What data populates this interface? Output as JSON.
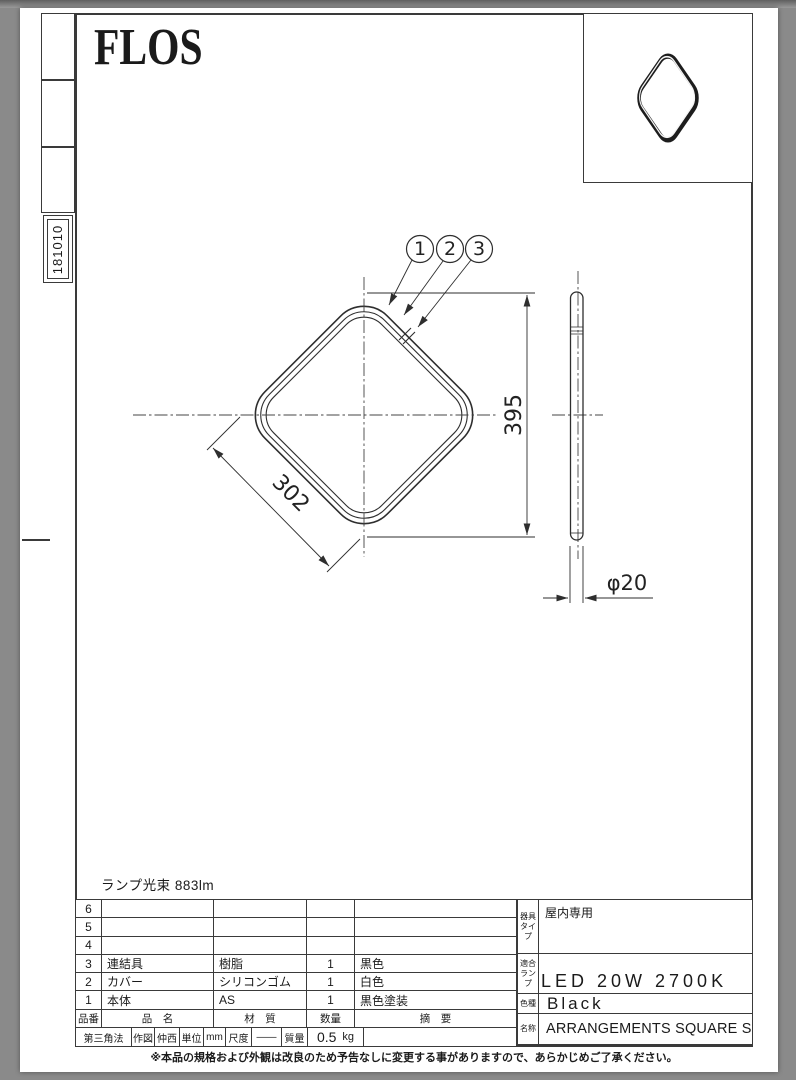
{
  "page": {
    "logo": "FLOS",
    "drawing_number": "181010",
    "lamp_flux": "ランプ光束 883lm",
    "note": "※本品の規格および外観は改良のため予告なしに変更する事がありますので、あらかじめご了承ください。"
  },
  "drawing": {
    "dim_edge": "302",
    "dim_height": "395",
    "dim_tube": "φ20",
    "callout_1": "1",
    "callout_2": "2",
    "callout_3": "3"
  },
  "parts_table": {
    "header": {
      "no": "品番",
      "name": "品　名",
      "material": "材　質",
      "qty": "数量",
      "remark": "摘　要"
    },
    "rows": [
      {
        "no": "6",
        "name": "",
        "material": "",
        "qty": "",
        "remark": ""
      },
      {
        "no": "5",
        "name": "",
        "material": "",
        "qty": "",
        "remark": ""
      },
      {
        "no": "4",
        "name": "",
        "material": "",
        "qty": "",
        "remark": ""
      },
      {
        "no": "3",
        "name": "連結具",
        "material": "樹脂",
        "qty": "1",
        "remark": "黒色"
      },
      {
        "no": "2",
        "name": "カバー",
        "material": "シリコンゴム",
        "qty": "1",
        "remark": "白色"
      },
      {
        "no": "1",
        "name": "本体",
        "material": "AS",
        "qty": "1",
        "remark": "黒色塗装"
      }
    ]
  },
  "title_block": {
    "projection": "第三角法",
    "drafter_label": "作図",
    "drafter": "仲西",
    "unit_label": "単位",
    "unit": "mm",
    "scale_label": "尺度",
    "scale": "——",
    "mass_label": "質量",
    "mass": "0.5",
    "mass_unit": "kg"
  },
  "spec": {
    "fixture_type_label": "器具\nタイプ",
    "fixture_type": "屋内専用",
    "lamp_label": "適合\nランプ",
    "lamp": "LED 20W 2700K",
    "color_label": "色種",
    "color": "Black",
    "name_label": "名称",
    "product_name": "ARRANGEMENTS SQUARE SMALL"
  }
}
